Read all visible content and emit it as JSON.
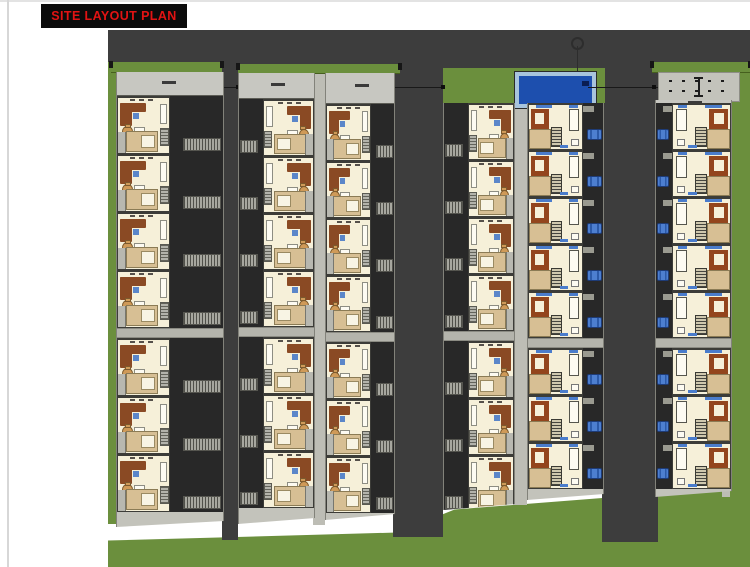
{
  "title": {
    "label": "SITE LAYOUT PLAN"
  },
  "site": {
    "colors": {
      "title_red": "#e21313",
      "road": "#3d3d3d",
      "grass": "#6b8f3d",
      "walkway": "#bdbdb5",
      "strip_bg": "#c3c3bb",
      "dark_block": "#282828",
      "floor": "#f6f0d9",
      "tan": "#d7bf94",
      "sofa": "#8a4a24",
      "sofa2": "#93451d",
      "dining": "#cf9a58",
      "blue": "#5b86c9",
      "win_blue": "#4a7ccc",
      "car": "#4d7fd0",
      "pool_water": "#1d4fae",
      "pool_deck": "#a8c4dc"
    },
    "features": {
      "top_road": {
        "x": 108,
        "y": 30,
        "w": 642,
        "h": 42
      },
      "left_grass": {
        "x": 108,
        "y": 62,
        "w": 8,
        "h": 462
      },
      "right_grass": {
        "x": 728,
        "y": 68,
        "w": 22,
        "h": 402
      },
      "bottom_grass": {
        "x": 108,
        "y": 452,
        "w": 642,
        "h": 115
      },
      "alley_road": {
        "x": 222,
        "y": 62,
        "w": 16,
        "h": 478
      },
      "road_34": {
        "x": 393,
        "y": 66,
        "w": 50,
        "h": 471
      },
      "road_56": {
        "x": 602,
        "y": 66,
        "w": 56,
        "h": 476
      },
      "spine_23": {
        "x": 313,
        "y": 73,
        "w": 12,
        "h": 452
      },
      "spine_45": {
        "x": 513,
        "y": 103,
        "w": 14,
        "h": 402
      },
      "spine_6r": {
        "x": 722,
        "y": 100,
        "w": 8,
        "h": 397
      },
      "band_1": {
        "x": 111,
        "y": 62,
        "w": 111,
        "h": 10
      },
      "band_23": {
        "x": 238,
        "y": 64,
        "w": 162,
        "h": 9
      },
      "pool_area": {
        "x": 443,
        "y": 68,
        "w": 162,
        "h": 35
      },
      "band_6": {
        "x": 652,
        "y": 62,
        "w": 98,
        "h": 10
      },
      "cross_1": {
        "x": 222,
        "y": 87,
        "w": 16,
        "h": 1
      },
      "cross_2": {
        "x": 393,
        "y": 87,
        "w": 50,
        "h": 1
      },
      "cross_3": {
        "x": 588,
        "y": 87,
        "w": 70,
        "h": 1
      },
      "tick_1": {
        "x": 236,
        "y": 85,
        "w": 4,
        "h": 4
      },
      "tick_2": {
        "x": 441,
        "y": 85,
        "w": 4,
        "h": 4
      },
      "tick_3": {
        "x": 652,
        "y": 85,
        "w": 4,
        "h": 4
      }
    },
    "strips": [
      {
        "id": 1,
        "x": 116,
        "y": 72,
        "w": 106,
        "h": 455,
        "header_h": 23,
        "style": "standard",
        "mirrored": false,
        "fp_pct": 50,
        "groups": [
          4,
          3
        ],
        "unit_h": 58
      },
      {
        "id": 2,
        "x": 238,
        "y": 73,
        "w": 75,
        "h": 451,
        "header_h": 25,
        "style": "standard",
        "mirrored": true,
        "fp_pct": 68,
        "groups": [
          4,
          3
        ],
        "unit_h": 57
      },
      {
        "id": 3,
        "x": 325,
        "y": 73,
        "w": 68,
        "h": 447,
        "header_h": 30,
        "style": "standard",
        "mirrored": false,
        "fp_pct": 66,
        "groups": [
          4,
          3
        ],
        "unit_h": 57
      },
      {
        "id": 4,
        "x": 443,
        "y": 103,
        "w": 70,
        "h": 407,
        "header_h": 0,
        "style": "standard",
        "mirrored": true,
        "fp_pct": 66,
        "groups": [
          4,
          3
        ],
        "unit_h": 57
      },
      {
        "id": 5,
        "x": 527,
        "y": 103,
        "w": 75,
        "h": 397,
        "header_h": 0,
        "style": "modern",
        "mirrored": false,
        "fp_pct": 73,
        "groups": [
          5,
          3
        ],
        "unit_h": 47
      },
      {
        "id": 6,
        "x": 655,
        "y": 100,
        "w": 75,
        "h": 397,
        "header_h": 3,
        "style": "modern",
        "mirrored": true,
        "fp_pct": 78,
        "groups": [
          5,
          3
        ],
        "unit_h": 47
      }
    ],
    "amenities": {
      "pool": "swimming-pool",
      "court": "sports-court",
      "survey_marker": "survey-marker"
    }
  }
}
